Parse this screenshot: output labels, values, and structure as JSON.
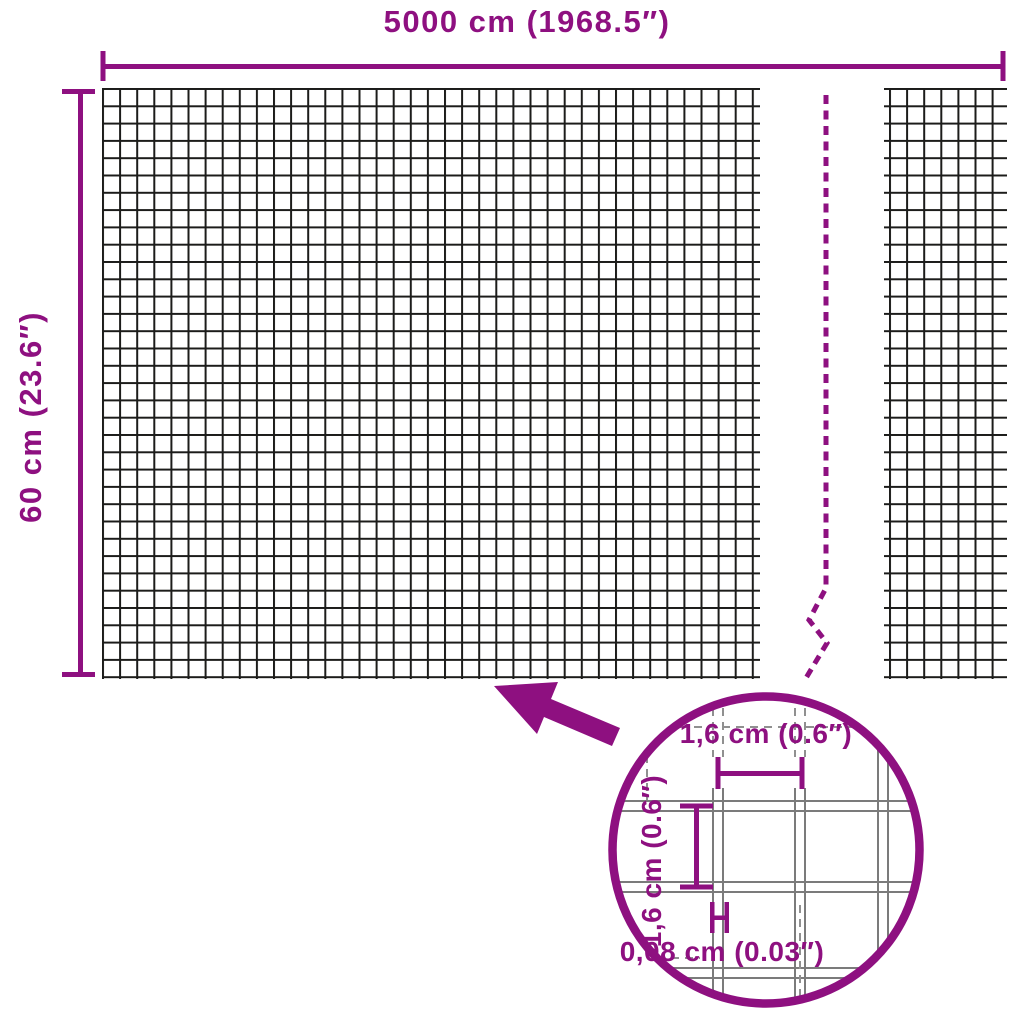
{
  "labels": {
    "roll_width": "5000 cm (1968.5″)",
    "roll_height": "60 cm (23.6″)",
    "cell_width": "1,6 cm (0.6″)",
    "cell_height": "1,6 cm (0.6″)",
    "wire_thickness": "0,08 cm (0.03″)"
  },
  "colors": {
    "accent": "#8E1080",
    "mesh_line": "#1C1C1A",
    "magnified_wire": "#7B7B7B",
    "magnified_wire_dashed": "#909090",
    "background": "#FFFFFF"
  }
}
